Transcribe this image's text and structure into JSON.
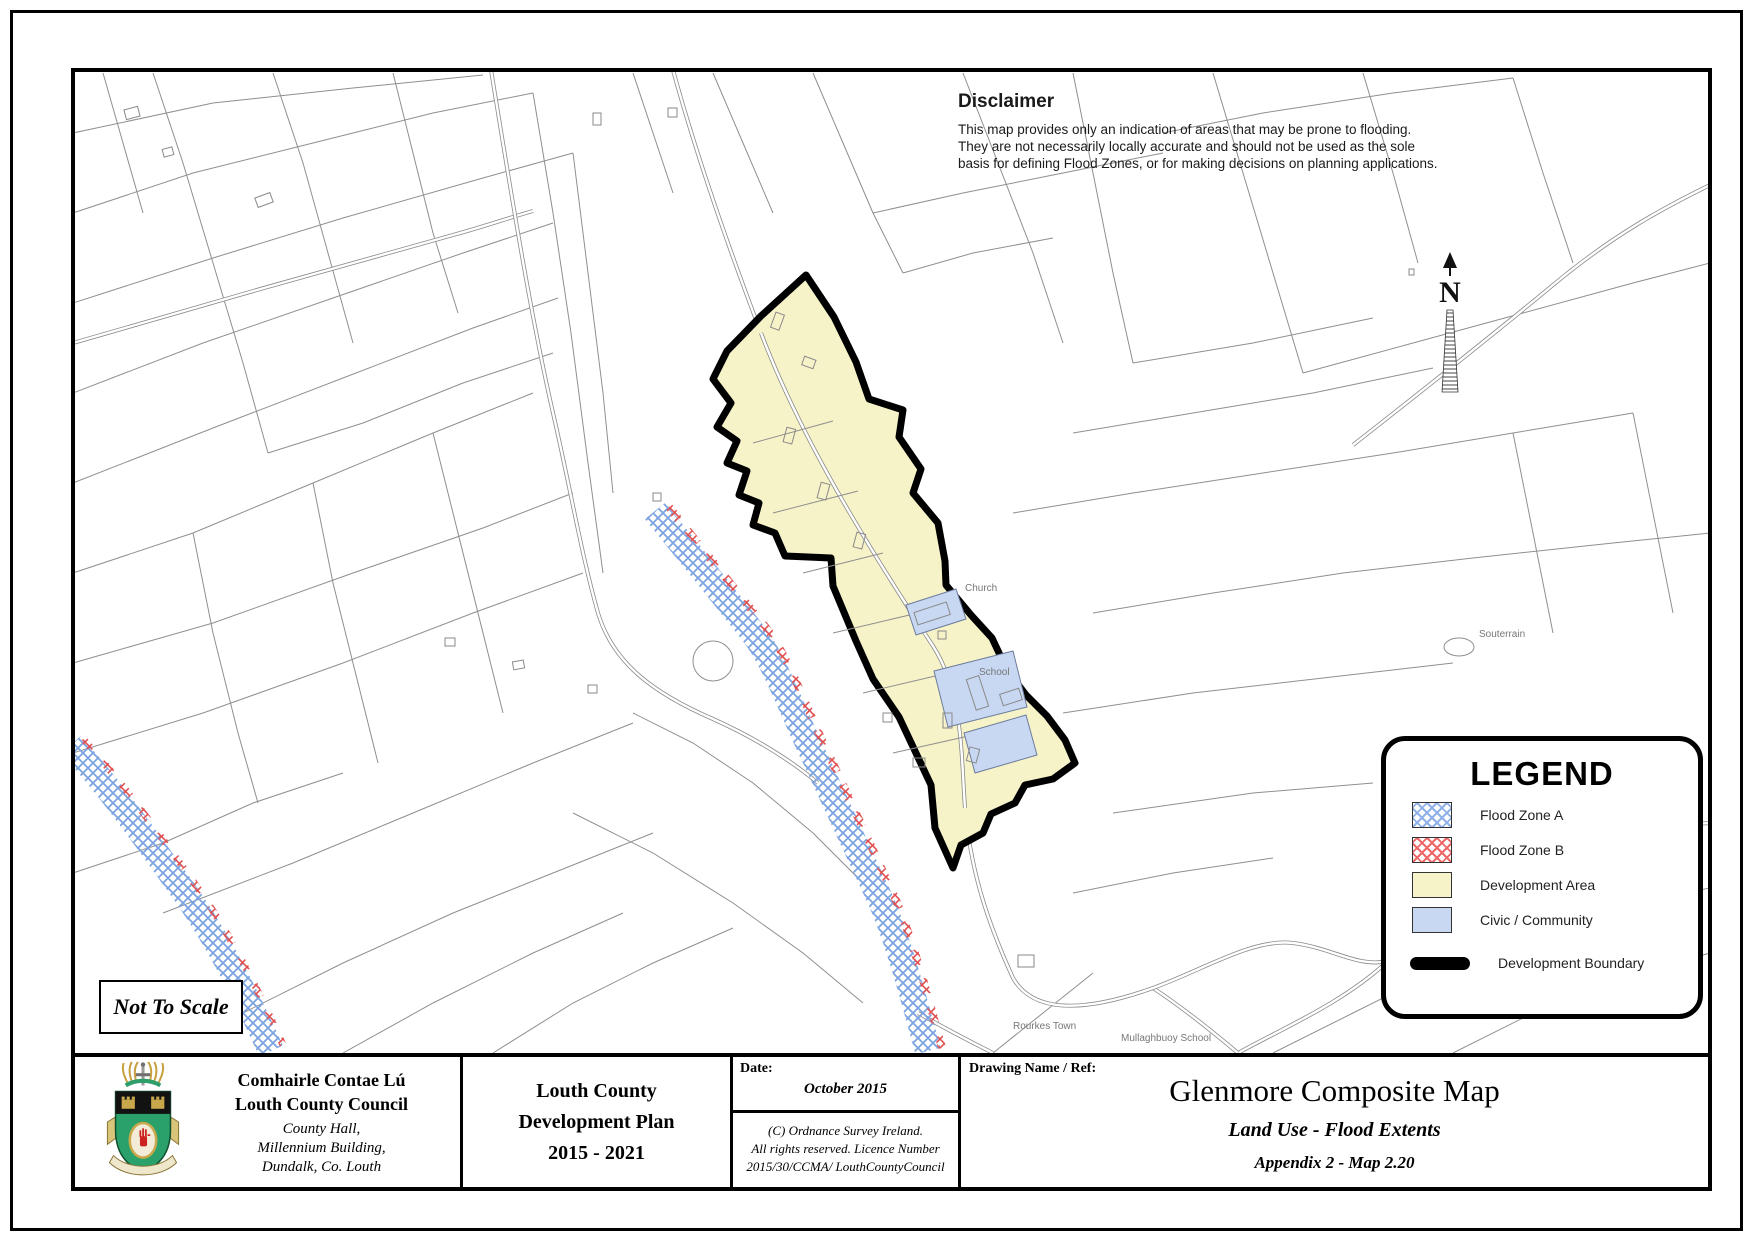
{
  "disclaimer": {
    "title": "Disclaimer",
    "line1": "This map provides only an indication of areas that may be prone to flooding.",
    "line2": "They are not necessarily locally accurate and should not be used as the sole",
    "line3": "basis for defining Flood Zones, or for making decisions on planning applications."
  },
  "north": {
    "label": "N"
  },
  "scale_note": "Not To Scale",
  "map_labels": {
    "church": "Church",
    "school": "School",
    "souterrain": "Souterrain",
    "rourkes_town": "Rourkes Town",
    "mullaghbuoy_school": "Mullaghbuoy School"
  },
  "legend": {
    "title": "LEGEND",
    "items": [
      {
        "label": "Flood Zone A",
        "swatch": "blue-crosshatch"
      },
      {
        "label": "Flood Zone B",
        "swatch": "red-crosshatch"
      },
      {
        "label": "Development Area",
        "swatch": "#f7f3c8"
      },
      {
        "label": "Civic / Community",
        "swatch": "#c8d7f2"
      },
      {
        "label": "Development Boundary",
        "swatch": "black-line"
      }
    ]
  },
  "footer": {
    "council": {
      "name_irish": "Comhairle Contae Lú",
      "name_english": "Louth County Council",
      "address_line1": "County Hall,",
      "address_line2": "Millennium Building,",
      "address_line3": "Dundalk, Co. Louth"
    },
    "plan": {
      "line1": "Louth County",
      "line2": "Development Plan",
      "line3": "2015 - 2021"
    },
    "date": {
      "label": "Date:",
      "value": "October 2015",
      "copyright_line1": "(C) Ordnance Survey Ireland.",
      "copyright_line2": "All rights reserved. Licence Number",
      "copyright_line3": "2015/30/CCMA/ LouthCountyCouncil"
    },
    "drawing": {
      "label": "Drawing Name / Ref:",
      "title": "Glenmore Composite Map",
      "subtitle": "Land Use - Flood Extents",
      "appendix": "Appendix 2 - Map 2.20"
    }
  },
  "colors": {
    "development_area": "#f7f3c8",
    "civic_community": "#c8d7f2",
    "flood_zone_a": "#7aa3e0",
    "flood_zone_b": "#e05050",
    "development_boundary": "#000000",
    "map_lines": "#8f8f8f"
  }
}
